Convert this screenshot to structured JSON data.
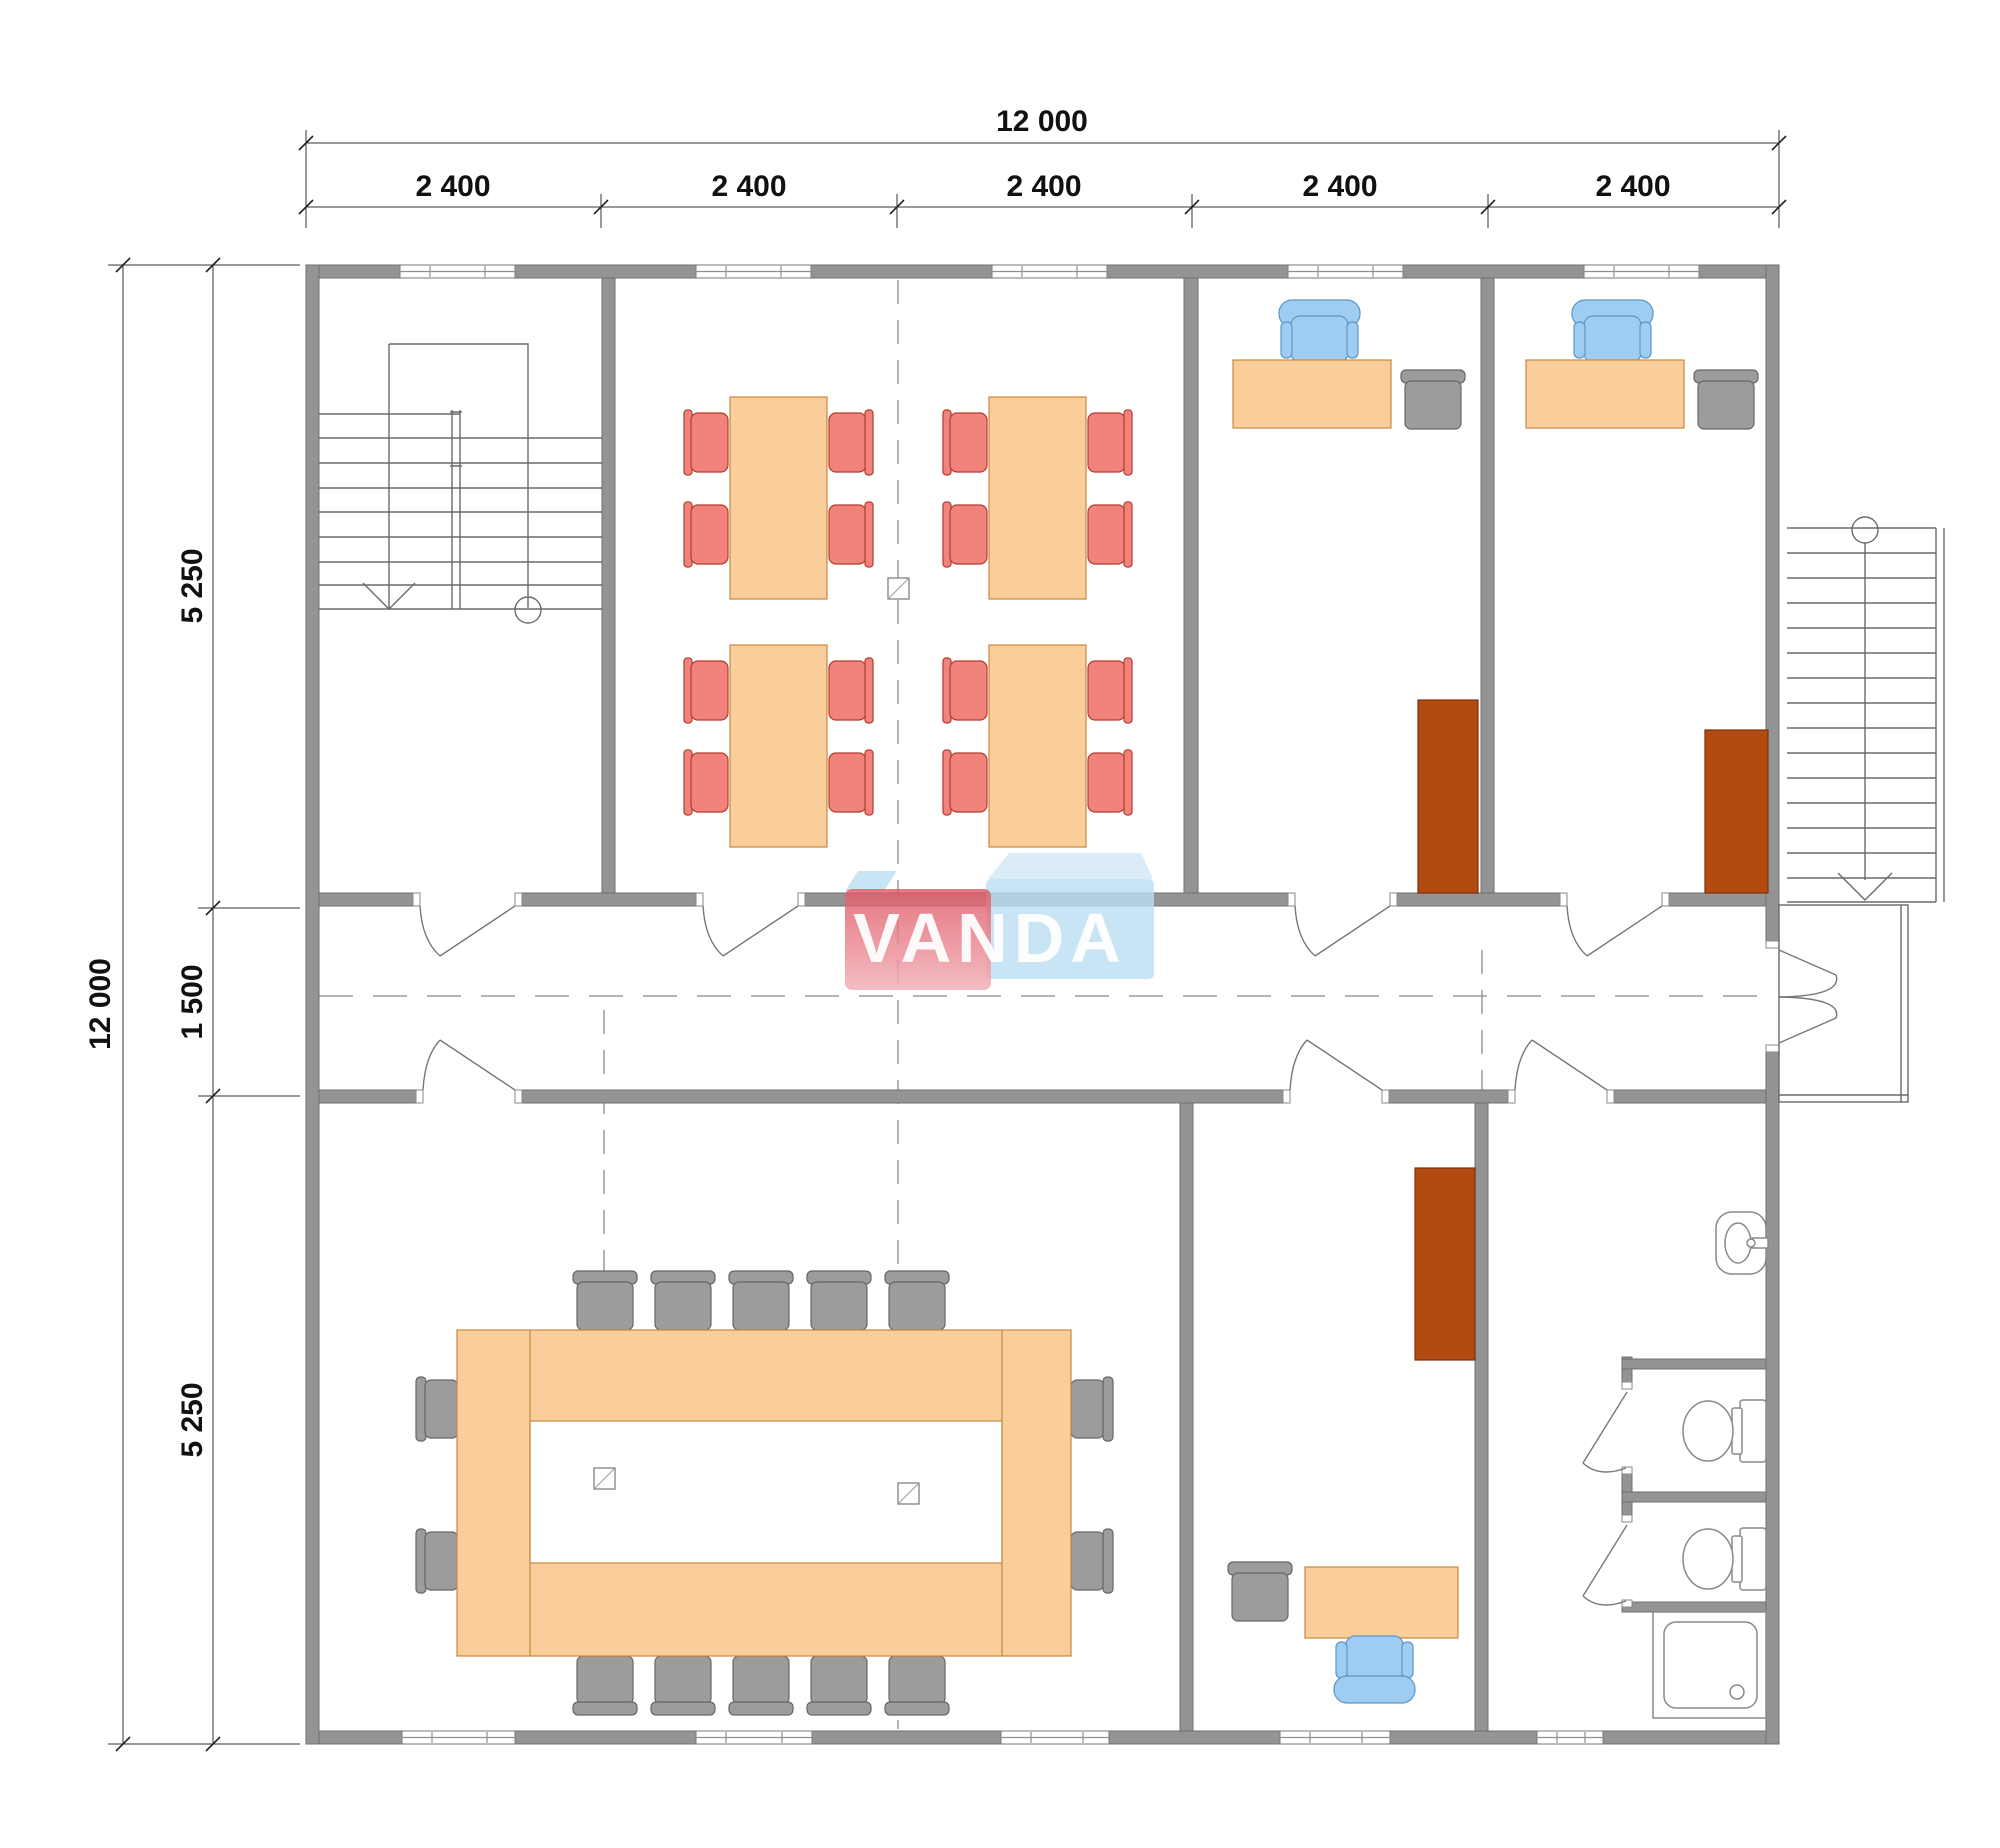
{
  "meta": {
    "kind": "architectural-floor-plan",
    "units": "mm"
  },
  "dims": {
    "top": {
      "total": "12 000",
      "bays": [
        "2 400",
        "2 400",
        "2 400",
        "2 400",
        "2 400"
      ]
    },
    "left": {
      "total": "12 000",
      "rows": [
        "5 250",
        "1 500",
        "5 250"
      ]
    }
  },
  "logo": {
    "text": "VANDA"
  },
  "colors": {
    "wall": "#949494",
    "wall_stroke": "#6f6f6f",
    "desk": "#F9CE9A",
    "desk_stroke": "#C8883F",
    "chair_red": "#F2837B",
    "chair_red_stroke": "#B23B30",
    "chair_blue": "#9FCCF1",
    "chair_blue_stroke": "#5A96C8",
    "chair_gray": "#9C9C9C",
    "chair_gray_stroke": "#666666",
    "cabinet": "#B34A10",
    "cabinet_stroke": "#7D3008",
    "logo_blue": "#BBDDF2",
    "logo_red": "#E4636E",
    "logo_red_light": "#F2AFB6"
  },
  "inventory": {
    "rooms": [
      {
        "name": "stairwell-top-left",
        "items": [
          "internal-staircase",
          "down-arrow",
          "start-circle"
        ]
      },
      {
        "name": "canteen-top-middle",
        "items": [
          "table-with-4-red-chairs",
          "table-with-4-red-chairs",
          "table-with-4-red-chairs",
          "table-with-4-red-chairs",
          "column"
        ]
      },
      {
        "name": "office-top-1",
        "items": [
          "desk",
          "blue-office-chair",
          "gray-guest-chair",
          "brown-cabinet"
        ]
      },
      {
        "name": "office-top-2",
        "items": [
          "desk",
          "blue-office-chair",
          "gray-guest-chair",
          "brown-cabinet"
        ]
      },
      {
        "name": "corridor",
        "items": [
          "center-line",
          "five-swing-doors",
          "double-entrance-door"
        ]
      },
      {
        "name": "meeting-room-bottom-left",
        "items": [
          "ring-conference-table",
          "14-gray-chairs",
          "2-columns"
        ]
      },
      {
        "name": "office-bottom",
        "items": [
          "desk",
          "blue-office-chair",
          "gray-guest-chair",
          "brown-cabinet"
        ]
      },
      {
        "name": "bathroom-bottom-right",
        "items": [
          "sink",
          "toilet-stall",
          "toilet-stall",
          "shower-tray"
        ]
      },
      {
        "name": "exterior",
        "items": [
          "external-staircase",
          "entrance-platform"
        ]
      }
    ]
  }
}
